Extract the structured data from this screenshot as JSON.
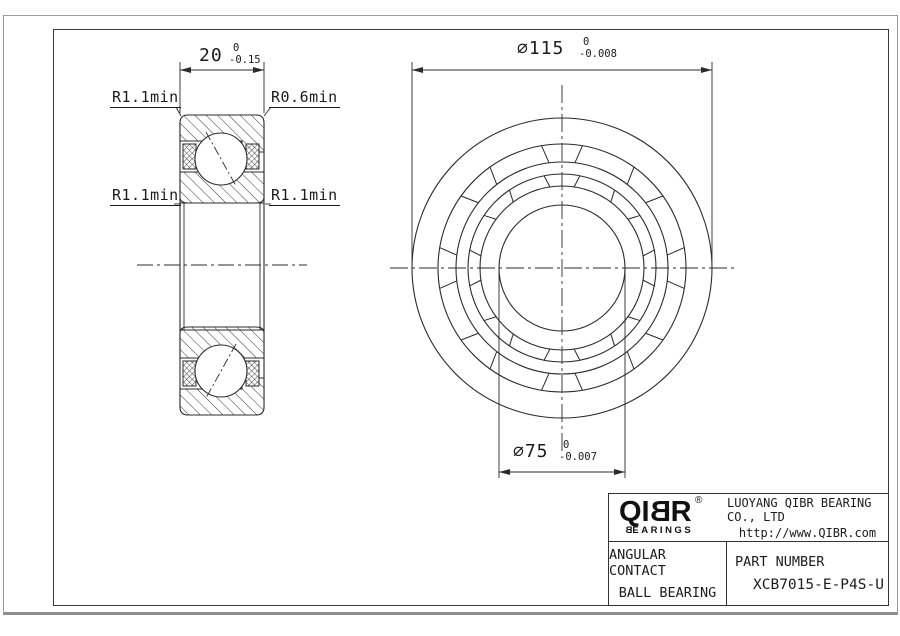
{
  "section_view": {
    "width_dim": {
      "value": "20",
      "tol_top": "0",
      "tol_bottom": "-0.15"
    },
    "radius_labels": {
      "top_left": "R1.1min",
      "top_right": "R0.6min",
      "bottom_left": "R1.1min",
      "bottom_right": "R1.1min"
    }
  },
  "front_view": {
    "outer_dia_dim": {
      "value": "⌀115",
      "tol_top": "0",
      "tol_bottom": "-0.008"
    },
    "bore_dia_dim": {
      "value": "⌀75",
      "tol_top": "0",
      "tol_bottom": "-0.007"
    }
  },
  "title_block": {
    "logo": {
      "prefix": "QI",
      "flipped_letter": "B",
      "suffix": "R",
      "registered": "®",
      "sub_flipped": "B",
      "sub_rest": "EARINGS"
    },
    "company": "LUOYANG QIBR BEARING CO., LTD",
    "website": "http://www.QIBR.com",
    "product_line1": "ANGULAR CONTACT",
    "product_line2": "BALL BEARING",
    "part_number_label": "PART NUMBER",
    "part_number": "XCB7015-E-P4S-U"
  }
}
